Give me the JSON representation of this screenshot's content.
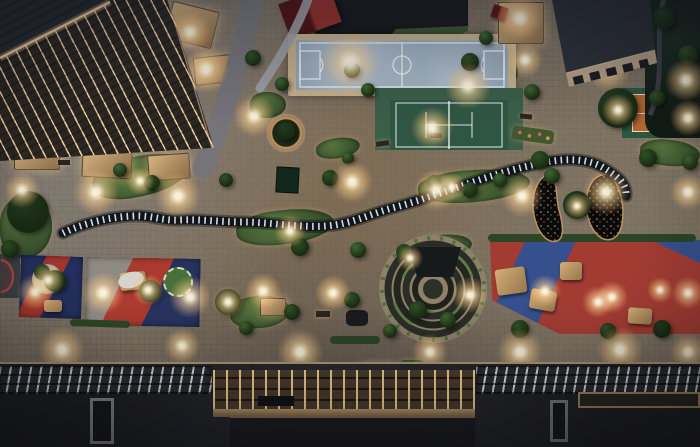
{
  "meta": {
    "description": "Night-time aerial render of a landscaped pocket-park plaza between residential towers, with sports courts, playgrounds, a winding slatted walkway and a circular amphitheatre",
    "width": 700,
    "height": 447
  },
  "palette": {
    "paving": "#7b7060",
    "paving_light": "#b3a78e",
    "paving_cool": "#8e8d92",
    "building_dark": "#26282c",
    "facade_light_line": "#f5d7a2",
    "futsal_surface": "#8fa2b3",
    "futsal_frame": "#c4b18c",
    "tennis_surround": "#3a5f49",
    "tennis_court": "#2f5643",
    "clay_surface": "#b4672f",
    "clay_border": "#2e5740",
    "court_line": "#ffffff",
    "grass": "#45603a",
    "tree_shades": [
      "#3f6530",
      "#2f5026",
      "#223a20"
    ],
    "walkway_dark": "#10151c",
    "walkway_slats": "#ebf2fa",
    "play_red": "#a23c33",
    "play_navy": "#24305e",
    "bean_fill": "#0a0a0c",
    "bean_speckle": "#caa152",
    "amphitheatre_rim": "#8e8069",
    "amphitheatre_ring": "#272a25",
    "amphitheatre_green": "#5d7b41",
    "lamp_glow": "#ffd9a0",
    "roof_dark": "#232429",
    "pergola_beam": "#ffd896",
    "bronze_frame": "#b59468",
    "red_roof": "#93312a"
  },
  "structures": [
    {
      "id": "building-top-left",
      "name": "lit residential tower roof and facade"
    },
    {
      "id": "building-top-right",
      "name": "low block with dark roof and window band"
    },
    {
      "id": "futsal-court",
      "name": "blue five-a-side football court"
    },
    {
      "id": "tennis-court",
      "name": "green tennis court"
    },
    {
      "id": "clay-court",
      "name": "orange clay court with green border"
    },
    {
      "id": "serpentine-walkway",
      "name": "dark slatted winding walkway"
    },
    {
      "id": "amphitheatre",
      "name": "circular stepped amphitheatre"
    },
    {
      "id": "bean-beds",
      "name": "two black kidney-shaped planted beds with lights"
    },
    {
      "id": "playground-left-a",
      "name": "navy/red play pad"
    },
    {
      "id": "playground-left-b",
      "name": "grey/red/navy play pad"
    },
    {
      "id": "playground-right",
      "name": "red/blue play field with timber equipment"
    },
    {
      "id": "bottom-roofs",
      "name": "podium rooftops with lit skylights and pergola grid"
    }
  ],
  "features": {
    "greens": [
      {
        "x": 92,
        "y": 156,
        "w": 98,
        "h": 40,
        "rot": -12
      },
      {
        "x": 316,
        "y": 138,
        "w": 44,
        "h": 20,
        "rot": -8
      },
      {
        "x": 236,
        "y": 210,
        "w": 98,
        "h": 34,
        "rot": -6
      },
      {
        "x": 418,
        "y": 170,
        "w": 112,
        "h": 32,
        "rot": -4
      },
      {
        "x": 410,
        "y": 235,
        "w": 62,
        "h": 24,
        "rot": -6
      },
      {
        "x": 250,
        "y": 92,
        "w": 36,
        "h": 26,
        "rot": 0
      },
      {
        "x": 458,
        "y": 50,
        "w": 60,
        "h": 44,
        "rot": 0
      },
      {
        "x": 230,
        "y": 296,
        "w": 60,
        "h": 32,
        "rot": -4
      },
      {
        "x": 0,
        "y": 196,
        "w": 52,
        "h": 62,
        "rot": 0
      },
      {
        "x": 640,
        "y": 140,
        "w": 60,
        "h": 26,
        "rot": 6
      },
      {
        "x": 78,
        "y": 118,
        "w": 32,
        "h": 22,
        "rot": -10
      }
    ],
    "trees": [
      {
        "x": 28,
        "y": 212,
        "r": 21,
        "s": 2
      },
      {
        "x": 10,
        "y": 249,
        "r": 9,
        "s": 1
      },
      {
        "x": 58,
        "y": 130,
        "r": 8,
        "s": 1
      },
      {
        "x": 24,
        "y": 137,
        "r": 7,
        "s": 0
      },
      {
        "x": 120,
        "y": 170,
        "r": 7,
        "s": 0
      },
      {
        "x": 152,
        "y": 183,
        "r": 8,
        "s": 1
      },
      {
        "x": 196,
        "y": 128,
        "r": 7,
        "s": 1
      },
      {
        "x": 253,
        "y": 58,
        "r": 8,
        "s": 1
      },
      {
        "x": 282,
        "y": 84,
        "r": 7,
        "s": 0
      },
      {
        "x": 226,
        "y": 180,
        "r": 7,
        "s": 1
      },
      {
        "x": 286,
        "y": 131,
        "r": 9,
        "s": 2
      },
      {
        "x": 330,
        "y": 178,
        "r": 8,
        "s": 1
      },
      {
        "x": 348,
        "y": 158,
        "r": 6,
        "s": 0
      },
      {
        "x": 300,
        "y": 247,
        "r": 9,
        "s": 1
      },
      {
        "x": 358,
        "y": 250,
        "r": 8,
        "s": 0
      },
      {
        "x": 404,
        "y": 252,
        "r": 8,
        "s": 1
      },
      {
        "x": 434,
        "y": 182,
        "r": 7,
        "s": 0
      },
      {
        "x": 470,
        "y": 190,
        "r": 8,
        "s": 1
      },
      {
        "x": 500,
        "y": 180,
        "r": 7,
        "s": 0
      },
      {
        "x": 352,
        "y": 70,
        "r": 8,
        "s": 1
      },
      {
        "x": 368,
        "y": 90,
        "r": 7,
        "s": 0
      },
      {
        "x": 470,
        "y": 62,
        "r": 9,
        "s": 1
      },
      {
        "x": 486,
        "y": 38,
        "r": 7,
        "s": 0
      },
      {
        "x": 577,
        "y": 205,
        "r": 14,
        "s": 2
      },
      {
        "x": 540,
        "y": 160,
        "r": 9,
        "s": 1
      },
      {
        "x": 552,
        "y": 176,
        "r": 8,
        "s": 0
      },
      {
        "x": 618,
        "y": 108,
        "r": 20,
        "s": 2
      },
      {
        "x": 575,
        "y": 28,
        "r": 10,
        "s": 1
      },
      {
        "x": 664,
        "y": 18,
        "r": 11,
        "s": 2
      },
      {
        "x": 688,
        "y": 55,
        "r": 10,
        "s": 1
      },
      {
        "x": 657,
        "y": 98,
        "r": 8,
        "s": 1
      },
      {
        "x": 532,
        "y": 92,
        "r": 8,
        "s": 0
      },
      {
        "x": 648,
        "y": 158,
        "r": 9,
        "s": 1
      },
      {
        "x": 690,
        "y": 162,
        "r": 8,
        "s": 0
      },
      {
        "x": 55,
        "y": 281,
        "r": 11,
        "s": 1
      },
      {
        "x": 150,
        "y": 291,
        "r": 11,
        "s": 2
      },
      {
        "x": 228,
        "y": 302,
        "r": 13,
        "s": 2
      },
      {
        "x": 292,
        "y": 312,
        "r": 8,
        "s": 1
      },
      {
        "x": 418,
        "y": 310,
        "r": 9,
        "s": 1
      },
      {
        "x": 448,
        "y": 320,
        "r": 8,
        "s": 0
      },
      {
        "x": 520,
        "y": 329,
        "r": 9,
        "s": 1
      },
      {
        "x": 608,
        "y": 331,
        "r": 8,
        "s": 1
      },
      {
        "x": 662,
        "y": 329,
        "r": 9,
        "s": 2
      },
      {
        "x": 246,
        "y": 328,
        "r": 7,
        "s": 0
      },
      {
        "x": 352,
        "y": 300,
        "r": 8,
        "s": 1
      },
      {
        "x": 390,
        "y": 331,
        "r": 7,
        "s": 0
      },
      {
        "x": 42,
        "y": 272,
        "r": 8,
        "s": 1
      }
    ],
    "lights": [
      [
        190,
        32,
        16
      ],
      [
        206,
        69,
        18
      ],
      [
        520,
        18,
        18
      ],
      [
        608,
        68,
        18
      ],
      [
        686,
        80,
        16
      ],
      [
        254,
        116,
        16
      ],
      [
        350,
        62,
        22
      ],
      [
        468,
        86,
        18
      ],
      [
        432,
        128,
        16
      ],
      [
        688,
        118,
        14
      ],
      [
        22,
        190,
        14
      ],
      [
        96,
        192,
        18
      ],
      [
        178,
        196,
        18
      ],
      [
        352,
        182,
        16
      ],
      [
        436,
        190,
        16
      ],
      [
        522,
        196,
        16
      ],
      [
        606,
        192,
        18
      ],
      [
        688,
        192,
        14
      ],
      [
        140,
        181,
        11
      ],
      [
        290,
        231,
        12
      ],
      [
        452,
        187,
        11
      ],
      [
        35,
        292,
        14
      ],
      [
        103,
        293,
        16
      ],
      [
        190,
        297,
        16
      ],
      [
        263,
        291,
        14
      ],
      [
        333,
        293,
        14
      ],
      [
        470,
        295,
        14
      ],
      [
        545,
        291,
        12
      ],
      [
        612,
        297,
        12
      ],
      [
        688,
        293,
        12
      ],
      [
        62,
        350,
        18
      ],
      [
        182,
        346,
        14
      ],
      [
        300,
        352,
        18
      ],
      [
        430,
        352,
        14
      ],
      [
        520,
        352,
        18
      ],
      [
        620,
        350,
        18
      ],
      [
        688,
        352,
        14
      ],
      [
        48,
        280,
        12
      ],
      [
        148,
        290,
        12
      ],
      [
        228,
        302,
        12
      ],
      [
        598,
        302,
        12
      ],
      [
        660,
        290,
        10
      ],
      [
        577,
        206,
        10
      ],
      [
        618,
        110,
        12
      ],
      [
        525,
        60,
        14
      ],
      [
        410,
        258,
        10
      ]
    ],
    "props": [
      {
        "type": "canopy",
        "x": 168,
        "y": 6,
        "w": 46,
        "h": 36,
        "rot": 14
      },
      {
        "type": "canopy",
        "x": 194,
        "y": 56,
        "w": 36,
        "h": 26,
        "rot": -6
      },
      {
        "type": "canopy",
        "x": 498,
        "y": 2,
        "w": 44,
        "h": 40,
        "rot": 0
      },
      {
        "type": "canopy",
        "x": 14,
        "y": 146,
        "w": 44,
        "h": 22,
        "rot": 0
      },
      {
        "type": "canopy",
        "x": 82,
        "y": 150,
        "w": 48,
        "h": 26,
        "rot": 3
      },
      {
        "type": "canopy",
        "x": 148,
        "y": 154,
        "w": 40,
        "h": 24,
        "rot": -4
      },
      {
        "type": "canopy",
        "x": 260,
        "y": 298,
        "w": 24,
        "h": 16,
        "rot": 0
      },
      {
        "type": "pond",
        "x": 276,
        "y": 167,
        "w": 21,
        "h": 24,
        "rot": 3
      },
      {
        "type": "mat",
        "x": 346,
        "y": 310,
        "w": 22,
        "h": 16,
        "rot": 0
      },
      {
        "type": "bench",
        "x": 316,
        "y": 311,
        "w": 14,
        "h": 6,
        "rot": 0
      },
      {
        "type": "bench",
        "x": 376,
        "y": 141,
        "w": 13,
        "h": 5,
        "rot": -8
      },
      {
        "type": "bench",
        "x": 58,
        "y": 160,
        "w": 12,
        "h": 5,
        "rot": 0
      },
      {
        "type": "bench",
        "x": 430,
        "y": 133,
        "w": 12,
        "h": 5,
        "rot": 0
      },
      {
        "type": "bench",
        "x": 520,
        "y": 114,
        "w": 12,
        "h": 5,
        "rot": 6
      },
      {
        "type": "flower",
        "x": 10,
        "y": 369,
        "w": 36,
        "h": 10,
        "rot": 0
      },
      {
        "type": "flower",
        "x": 253,
        "y": 365,
        "w": 36,
        "h": 9,
        "rot": 0
      },
      {
        "type": "flower",
        "x": 360,
        "y": 362,
        "w": 36,
        "h": 9,
        "rot": 0
      },
      {
        "type": "flower",
        "x": 400,
        "y": 360,
        "w": 24,
        "h": 9,
        "rot": 0
      },
      {
        "type": "flower",
        "x": 512,
        "y": 128,
        "w": 42,
        "h": 14,
        "rot": 8
      },
      {
        "type": "hedge",
        "x": 488,
        "y": 234,
        "w": 208,
        "h": 8,
        "rot": 0
      },
      {
        "type": "hedge",
        "x": 70,
        "y": 320,
        "w": 60,
        "h": 7,
        "rot": 2
      },
      {
        "type": "hedge",
        "x": 330,
        "y": 336,
        "w": 50,
        "h": 8,
        "rot": 0
      },
      {
        "type": "structure",
        "x": 496,
        "y": 268,
        "w": 30,
        "h": 26,
        "rot": -8
      },
      {
        "type": "structure",
        "x": 530,
        "y": 290,
        "w": 26,
        "h": 20,
        "rot": 10
      },
      {
        "type": "structure",
        "x": 560,
        "y": 262,
        "w": 22,
        "h": 18,
        "rot": 0
      },
      {
        "type": "structure",
        "x": 120,
        "y": 272,
        "w": 26,
        "h": 18,
        "rot": -5
      },
      {
        "type": "structure",
        "x": 44,
        "y": 300,
        "w": 18,
        "h": 12,
        "rot": 0
      },
      {
        "type": "structure",
        "x": 628,
        "y": 308,
        "w": 24,
        "h": 16,
        "rot": 4
      },
      {
        "type": "redroof",
        "x": 492,
        "y": 6,
        "w": 15,
        "h": 13,
        "rot": 18
      },
      {
        "type": "spinner",
        "x": 163,
        "y": 267,
        "w": 30,
        "h": 30,
        "rot": 0
      },
      {
        "type": "blob",
        "x": 118,
        "y": 272,
        "w": 26,
        "h": 16,
        "rot": -15
      },
      {
        "type": "circlepad",
        "x": 32,
        "y": 264,
        "w": 30,
        "h": 30,
        "rot": 0
      }
    ]
  }
}
